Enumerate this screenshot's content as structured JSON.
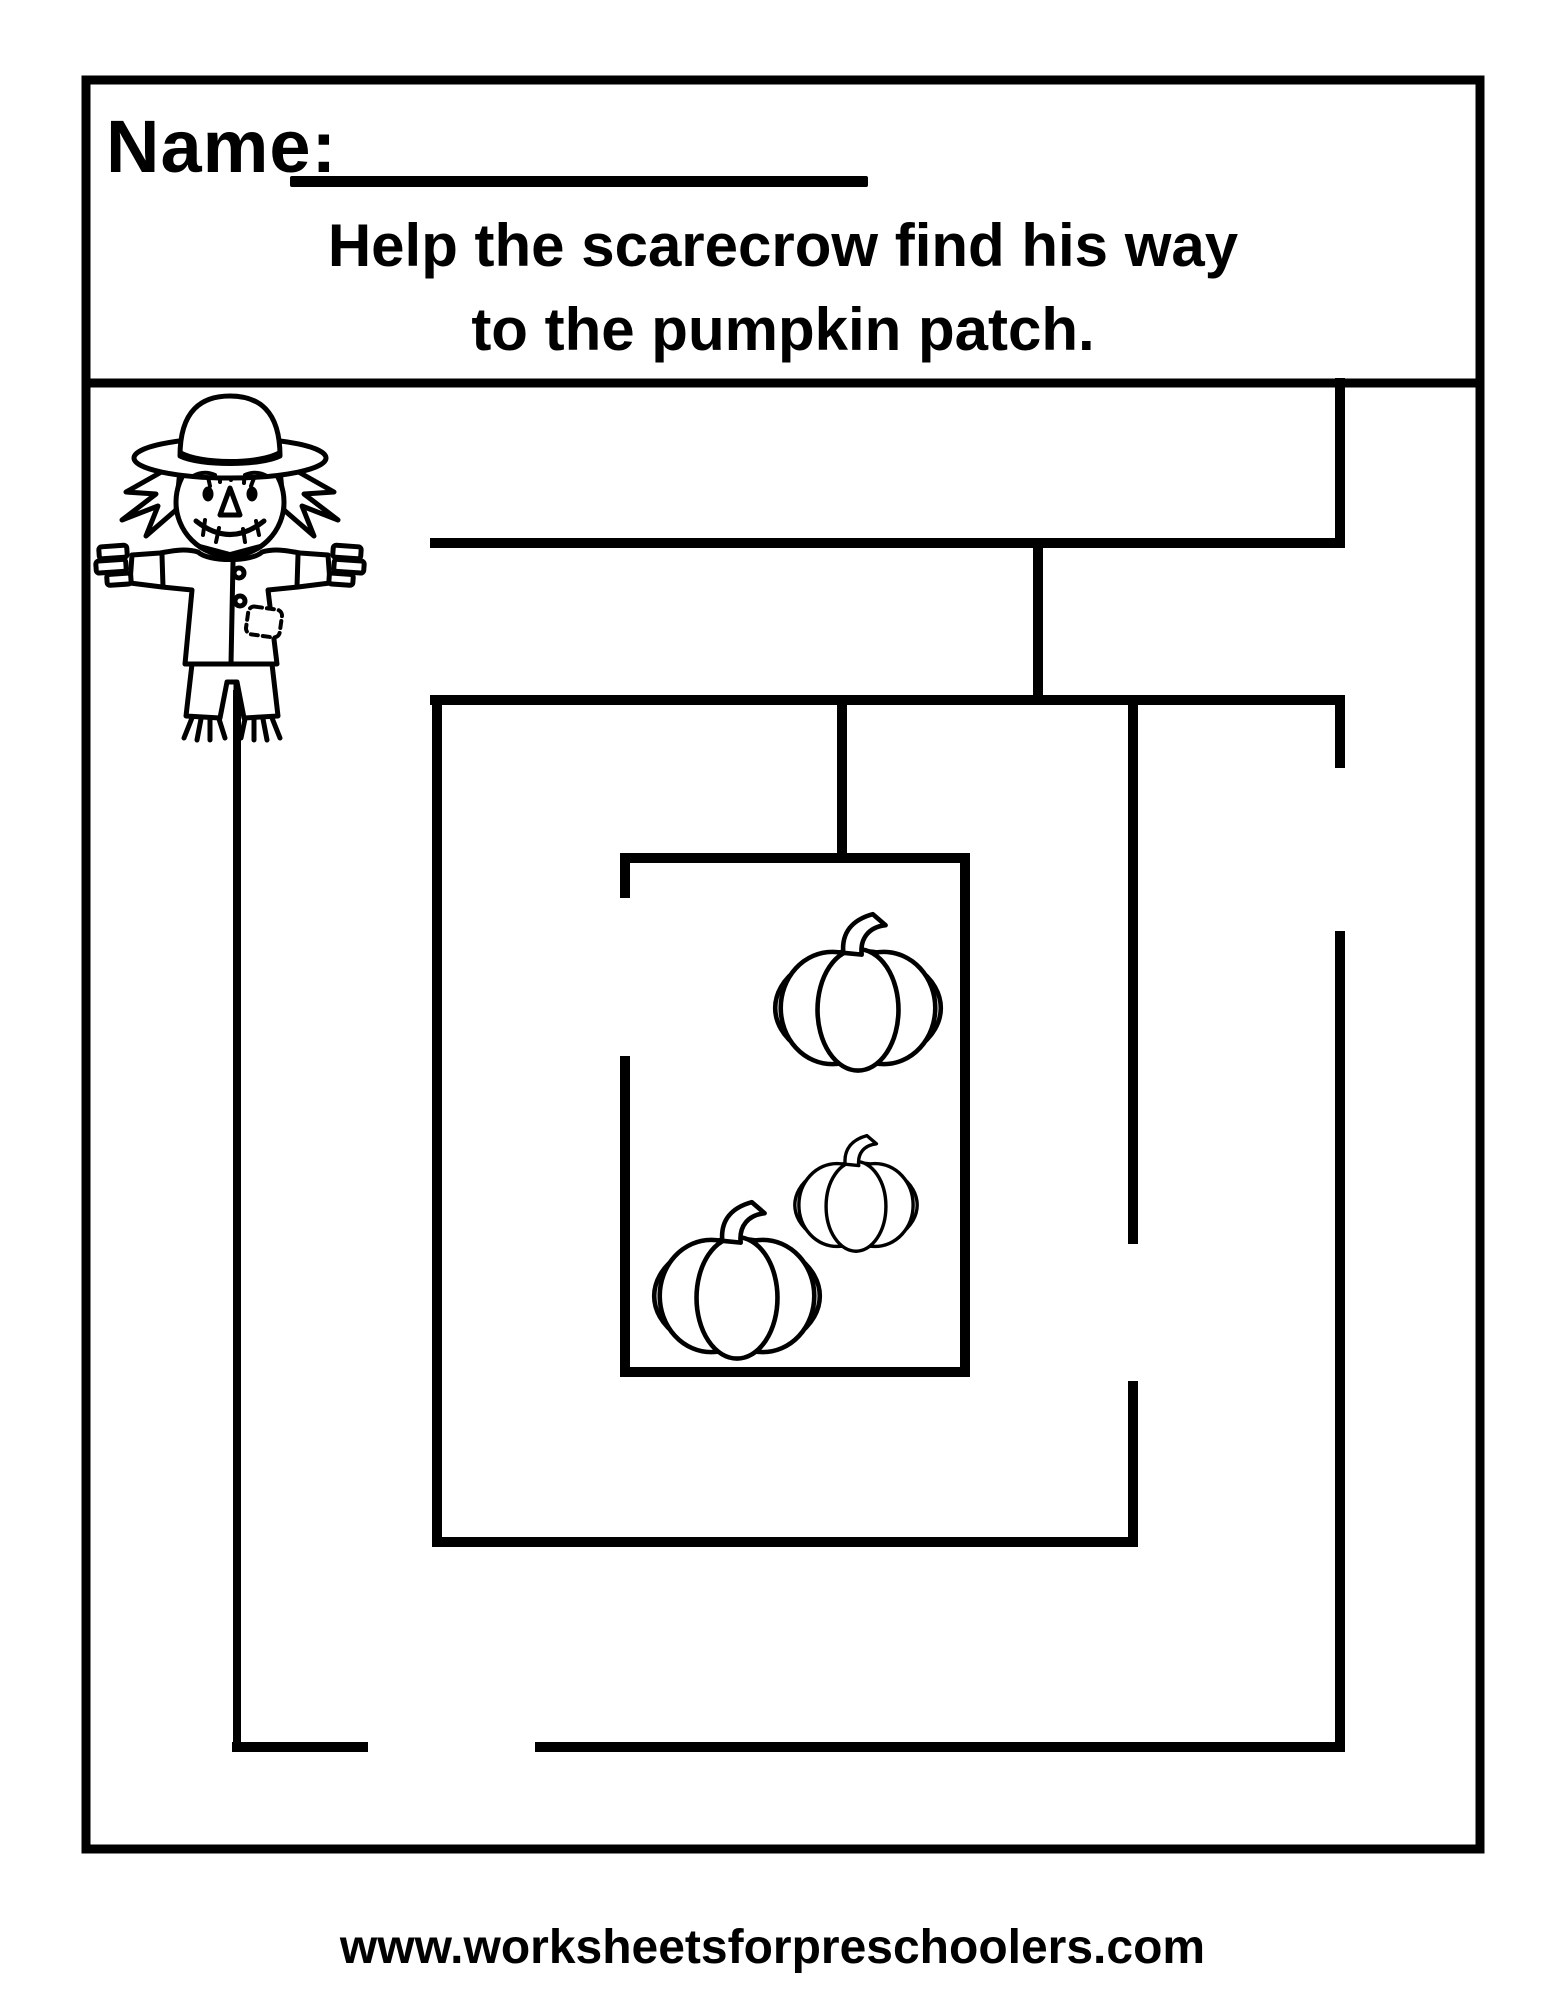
{
  "page": {
    "background": "#ffffff",
    "ink": "#000000",
    "width": 1545,
    "height": 2000
  },
  "header": {
    "name_label": "Name:",
    "name_value": "",
    "instruction_line1": "Help the scarecrow find his way",
    "instruction_line2": "to the pumpkin patch."
  },
  "footer": {
    "website": "www.worksheetsforpreschoolers.com"
  },
  "maze": {
    "start_icon": "scarecrow-icon",
    "goal_icon": "pumpkin-icon",
    "frame": [
      [
        86,
        80,
        1480,
        80,
        9
      ],
      [
        86,
        80,
        86,
        1849,
        9
      ],
      [
        1480,
        80,
        1480,
        1849,
        9
      ],
      [
        86,
        1849,
        1480,
        1849,
        9
      ],
      [
        86,
        383,
        1480,
        383,
        9
      ]
    ],
    "walls": [
      [
        1340,
        383,
        1340,
        543,
        10
      ],
      [
        435,
        543,
        1340,
        543,
        10
      ],
      [
        1038,
        543,
        1038,
        700,
        10
      ],
      [
        435,
        700,
        1340,
        700,
        10
      ],
      [
        1340,
        700,
        1340,
        763,
        10
      ],
      [
        1340,
        936,
        1340,
        1747,
        10
      ],
      [
        540,
        1747,
        1340,
        1747,
        10
      ],
      [
        237,
        1747,
        363,
        1747,
        10
      ],
      [
        237,
        694,
        237,
        1747,
        8
      ],
      [
        437,
        700,
        437,
        1542,
        10
      ],
      [
        437,
        1542,
        1133,
        1542,
        10
      ],
      [
        1133,
        1386,
        1133,
        1542,
        10
      ],
      [
        1133,
        700,
        1133,
        1239,
        10
      ],
      [
        842,
        700,
        842,
        858,
        10
      ],
      [
        625,
        858,
        965,
        858,
        10
      ],
      [
        965,
        858,
        965,
        1372,
        10
      ],
      [
        625,
        1372,
        965,
        1372,
        10
      ],
      [
        625,
        858,
        625,
        893,
        10
      ],
      [
        625,
        1061,
        625,
        1372,
        10
      ]
    ],
    "pumpkins": [
      {
        "cx": 858,
        "cy": 1008,
        "scale": 0.92
      },
      {
        "cx": 856,
        "cy": 1205,
        "scale": 0.68
      },
      {
        "cx": 737,
        "cy": 1296,
        "scale": 0.92
      }
    ]
  }
}
